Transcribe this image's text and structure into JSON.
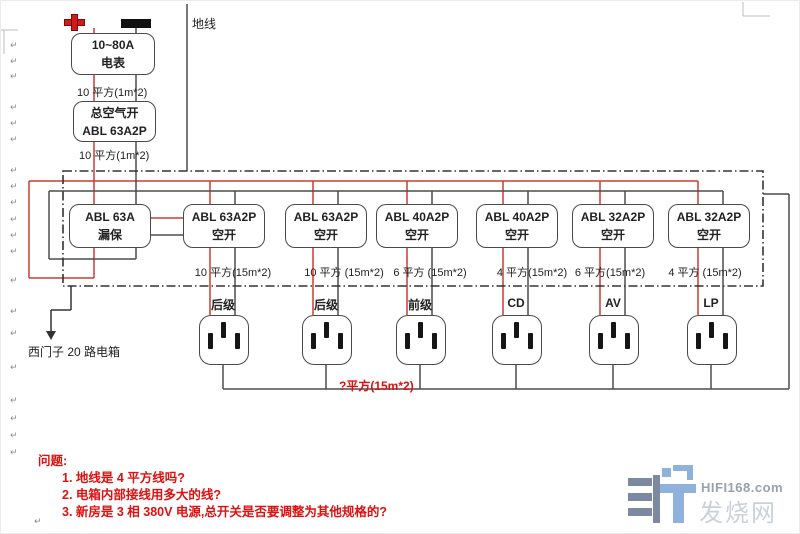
{
  "meter": {
    "line1": "10~80A",
    "line2": "电表"
  },
  "main_switch": {
    "line1": "总空气开",
    "line2": "ABL 63A2P"
  },
  "labels": {
    "ground": "地线",
    "meter_wire": "10 平方(1m*2)",
    "switch_wire": "10 平方(1m*2)",
    "panel_note": "西门子 20 路电箱",
    "socket_bus_wire": "?平方(15m*2)"
  },
  "breakers": [
    {
      "model": "ABL 63A",
      "type": "漏保",
      "wire": ""
    },
    {
      "model": "ABL 63A2P",
      "type": "空开",
      "wire": "10 平方(15m*2)"
    },
    {
      "model": "ABL 63A2P",
      "type": "空开",
      "wire": "10 平方 (15m*2)"
    },
    {
      "model": "ABL 40A2P",
      "type": "空开",
      "wire": "6 平方 (15m*2)"
    },
    {
      "model": "ABL 40A2P",
      "type": "空开",
      "wire": "4 平方(15m*2)"
    },
    {
      "model": "ABL 32A2P",
      "type": "空开",
      "wire": "6 平方(15m*2)"
    },
    {
      "model": "ABL 32A2P",
      "type": "空开",
      "wire": "4 平方 (15m*2)"
    }
  ],
  "sockets": [
    {
      "label": "后级"
    },
    {
      "label": "后级"
    },
    {
      "label": "前级"
    },
    {
      "label": "CD"
    },
    {
      "label": "AV"
    },
    {
      "label": "LP"
    }
  ],
  "questions": {
    "title": "问题:",
    "items": [
      "1. 地线是 4 平方线吗?",
      "2. 电箱内部接线用多大的线?",
      "3. 新房是 3 相 380V 电源,总开关是否要调整为其他规格的?"
    ]
  },
  "watermark": {
    "brand": "HIFI168.com",
    "site": "发烧网"
  },
  "colors": {
    "live": "#cf3a32",
    "neutral": "#4d4d4d",
    "accent_red": "#e01010",
    "watermark_gray_blue": "#7c89a0",
    "watermark_blue": "#8fb2dc"
  },
  "paragraph_mark": "↵"
}
